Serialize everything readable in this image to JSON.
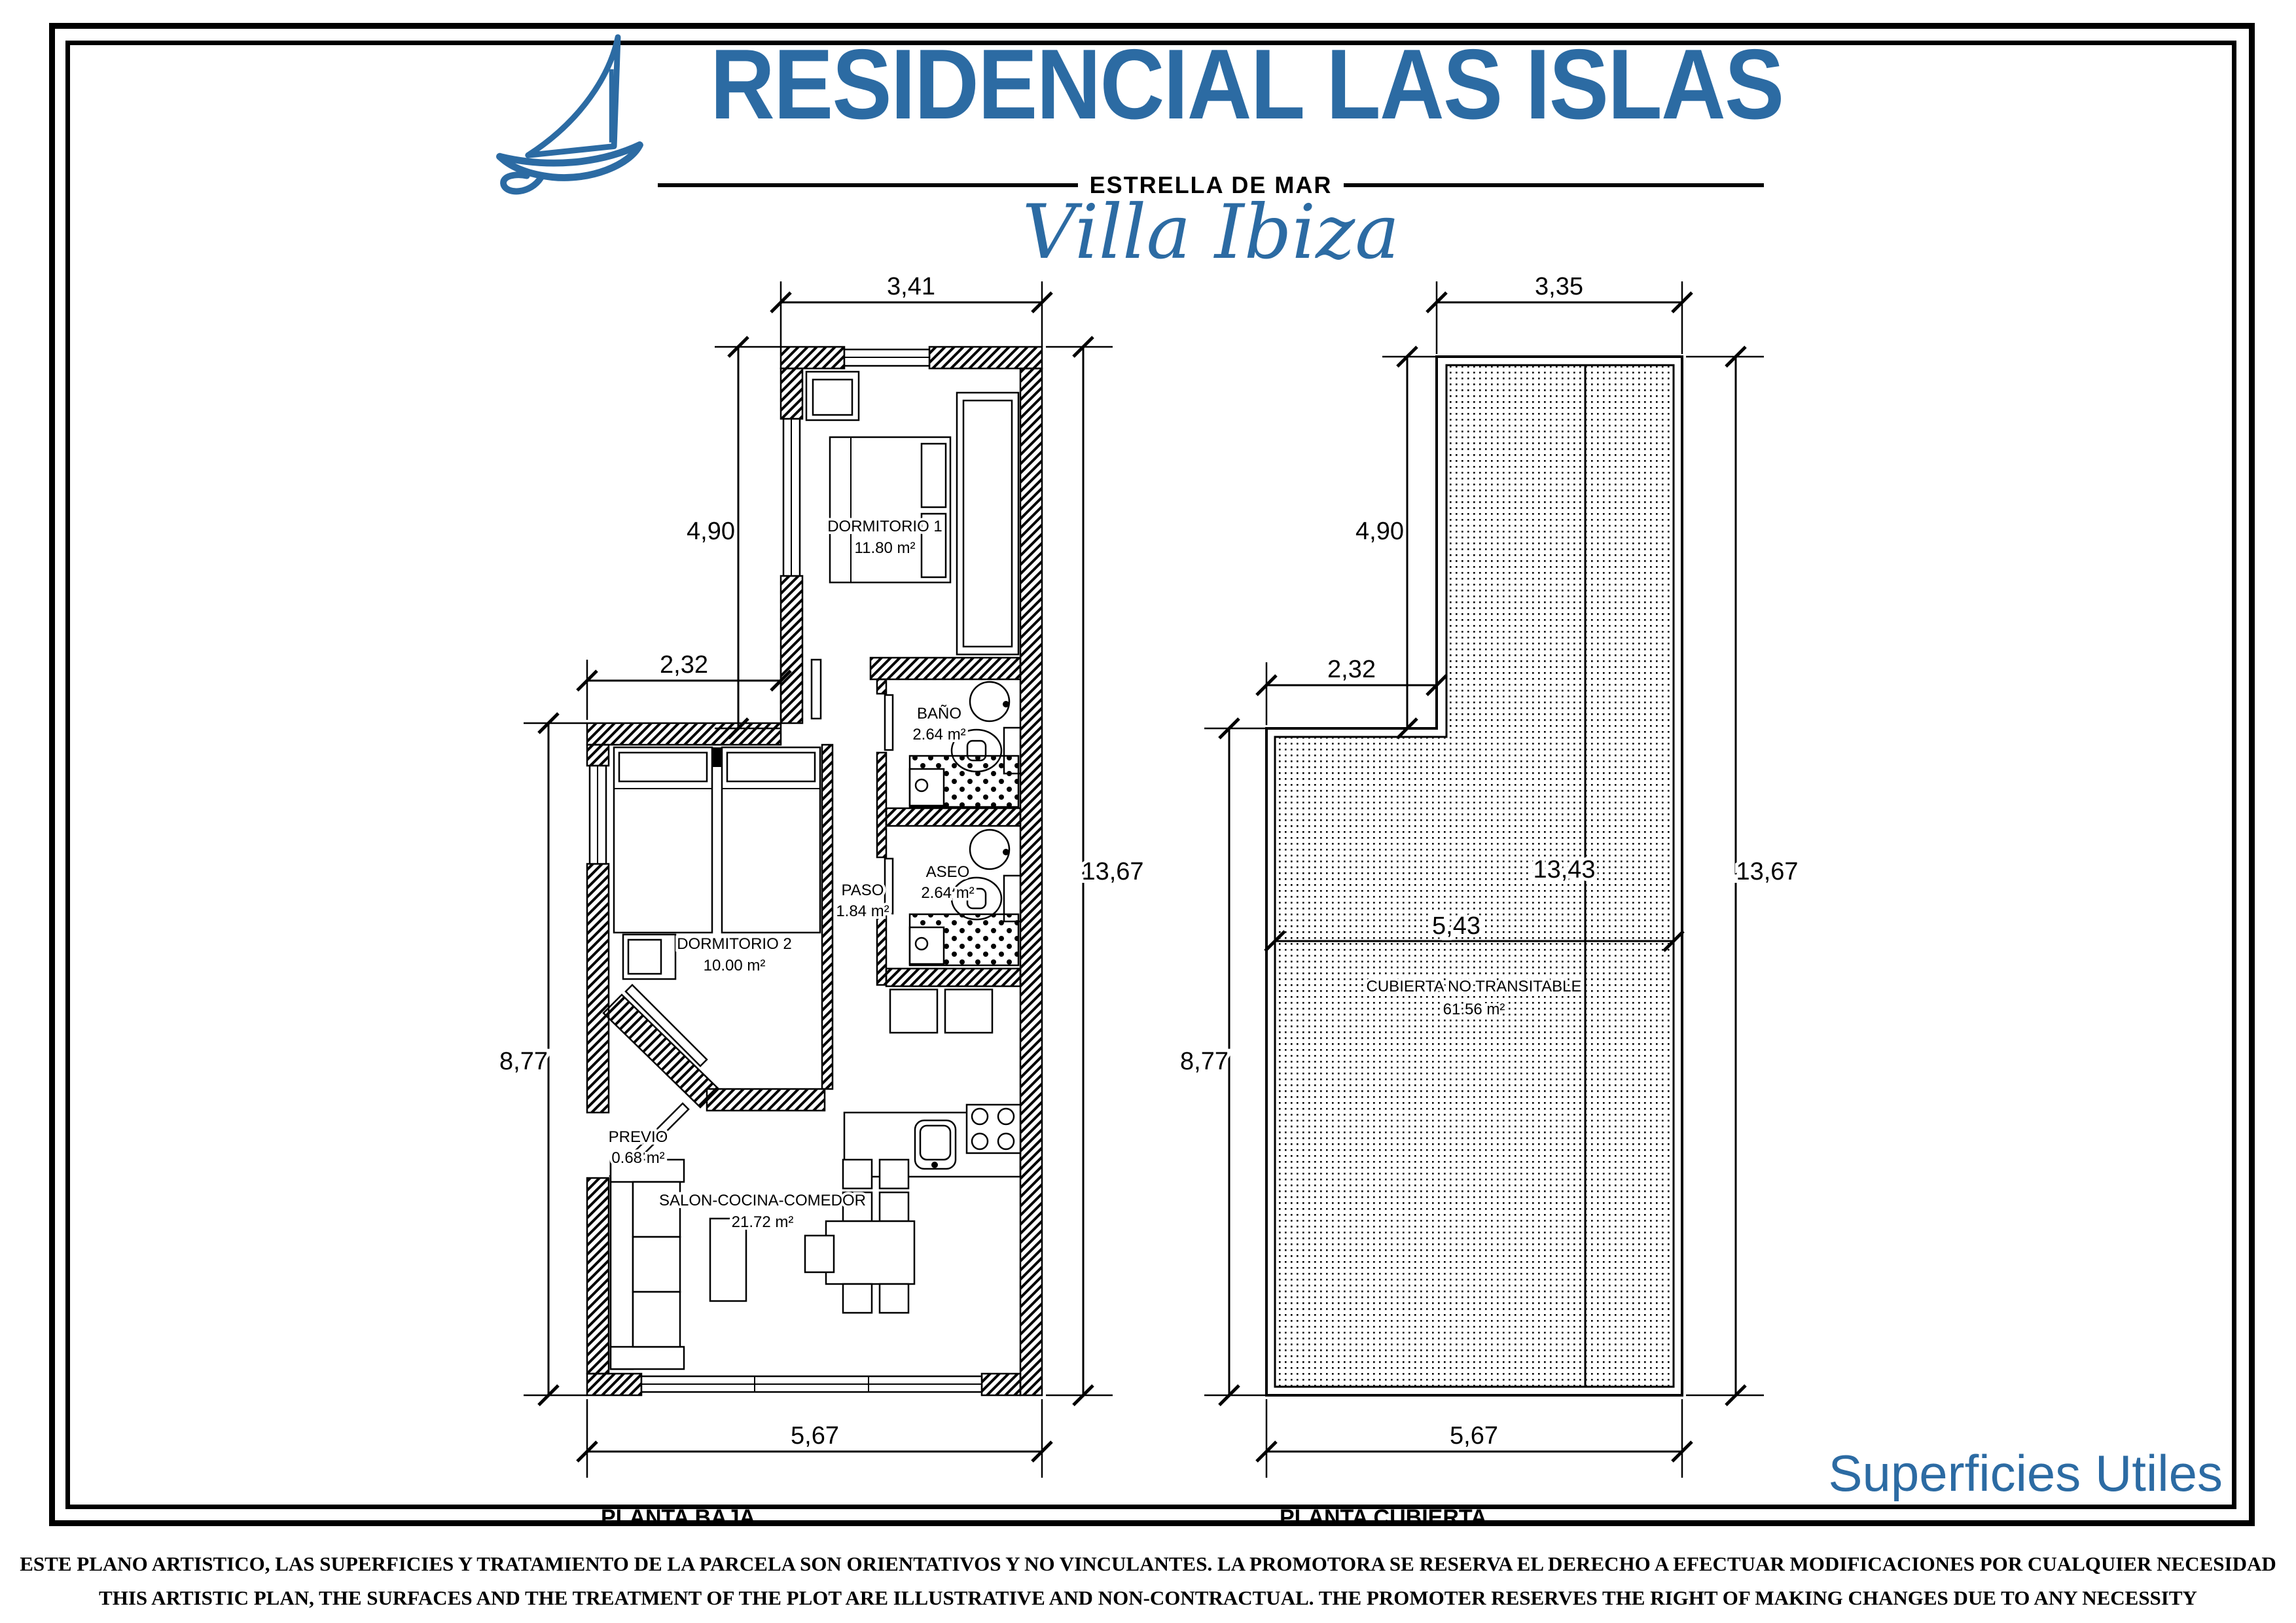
{
  "header": {
    "brand": "RESIDENCIAL LAS ISLAS",
    "subtitle": "ESTRELLA DE MAR",
    "villa_name": "Villa Ibiza"
  },
  "colors": {
    "brand_blue": "#2c6ba3"
  },
  "planta_baja": {
    "title": "PLANTA BAJA",
    "rooms": {
      "dormitorio1": {
        "name": "DORMITORIO 1",
        "area": "11.80 m²"
      },
      "bano": {
        "name": "BAÑO",
        "area": "2.64 m²"
      },
      "aseo": {
        "name": "ASEO",
        "area": "2.64 m²"
      },
      "paso": {
        "name": "PASO",
        "area": "1.84 m²"
      },
      "dormitorio2": {
        "name": "DORMITORIO 2",
        "area": "10.00 m²"
      },
      "previo": {
        "name": "PREVIO",
        "area": "0.68 m²"
      },
      "salon": {
        "name": "SALON-COCINA-COMEDOR",
        "area": "21.72 m²"
      }
    },
    "dims": {
      "top": "3,41",
      "upper_left": "4,90",
      "mid_left": "2,32",
      "right": "13,67",
      "lower_left": "8,77",
      "bottom": "5,67"
    }
  },
  "planta_cubierta": {
    "title": "PLANTA CUBIERTA",
    "rooms": {
      "cubierta": {
        "name": "CUBIERTA NO TRANSITABLE",
        "area": "61.56 m²"
      }
    },
    "dims": {
      "top": "3,35",
      "upper_left": "4,90",
      "mid_left": "2,32",
      "right": "13,67",
      "ridge": "13,43",
      "inner_width": "5,43",
      "lower_left": "8,77",
      "bottom": "5,67"
    }
  },
  "footer": {
    "superficies_label": "Superficies Utiles",
    "disclaimer_es": "ESTE PLANO ARTISTICO, LAS SUPERFICIES Y TRATAMIENTO DE LA PARCELA SON ORIENTATIVOS Y NO VINCULANTES. LA PROMOTORA SE RESERVA EL DERECHO A EFECTUAR MODIFICACIONES POR CUALQUIER NECESIDAD",
    "disclaimer_en": "THIS ARTISTIC PLAN, THE SURFACES AND THE TREATMENT OF THE PLOT ARE ILLUSTRATIVE AND NON-CONTRACTUAL. THE PROMOTER RESERVES THE RIGHT OF MAKING CHANGES DUE TO ANY NECESSITY"
  }
}
